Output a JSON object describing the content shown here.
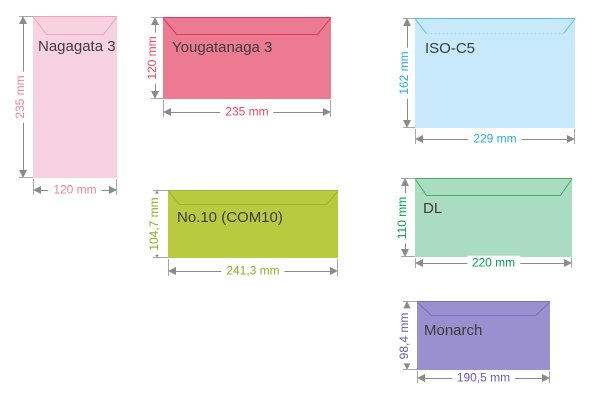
{
  "diagram": {
    "background": "#ffffff",
    "dim_line_color": "#8b8b8b",
    "title_color": "#3c3c3c",
    "envelopes": [
      {
        "name": "Nagagata 3",
        "height_label": "235 mm",
        "width_label": "120 mm",
        "fill": "#f9d2e1",
        "stroke": "#f0a3b2",
        "dim_color": "#ee8494"
      },
      {
        "name": "Yougatanaga 3",
        "height_label": "120 mm",
        "width_label": "235 mm",
        "fill": "#ec7b91",
        "stroke": "#e03a5f",
        "dim_color": "#e64562"
      },
      {
        "name": "ISO-C5",
        "height_label": "162 mm",
        "width_label": "229 mm",
        "fill": "#c8e9fb",
        "stroke": "#55bdee",
        "flap_dash": "#a0d9f6",
        "dim_color": "#25abe4"
      },
      {
        "name": "No.10 (COM10)",
        "height_label": "104,7 mm",
        "width_label": "241,3 mm",
        "fill": "#b8cb40",
        "stroke": "#9eb434",
        "dim_color": "#8dad2a"
      },
      {
        "name": "DL",
        "height_label": "110 mm",
        "width_label": "220 mm",
        "fill": "#aadcc2",
        "stroke": "#3eb15a",
        "dim_color": "#00a14c"
      },
      {
        "name": "Monarch",
        "height_label": "98,4 mm",
        "width_label": "190,5 mm",
        "fill": "#9a90cf",
        "stroke": "#7b6bc1",
        "dim_color": "#695cba"
      }
    ]
  }
}
